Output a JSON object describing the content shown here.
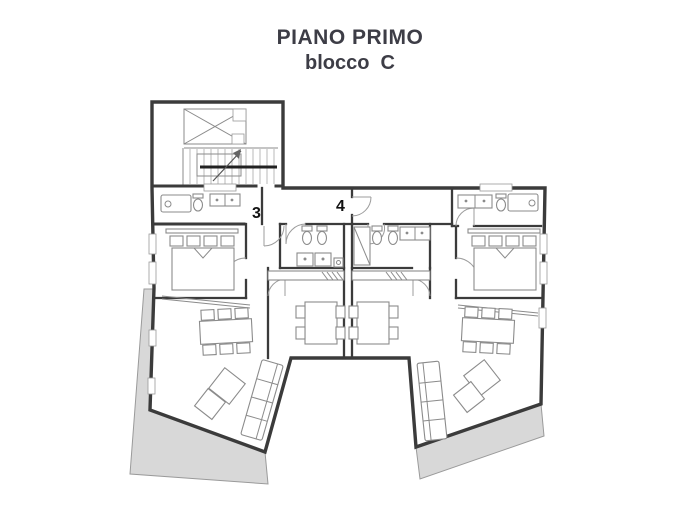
{
  "title": {
    "line1": "PIANO PRIMO",
    "line2": "blocco  C"
  },
  "units": {
    "unit3_label": "3",
    "unit4_label": "4"
  },
  "colors": {
    "wall": "#3b3b3b",
    "furniture_stroke": "#8b8b8b",
    "terrace_fill": "#d8d8d8",
    "terrace_stroke": "#9a9a9a",
    "title_text": "#3d3d46",
    "label_text": "#111111",
    "background": "#ffffff"
  }
}
